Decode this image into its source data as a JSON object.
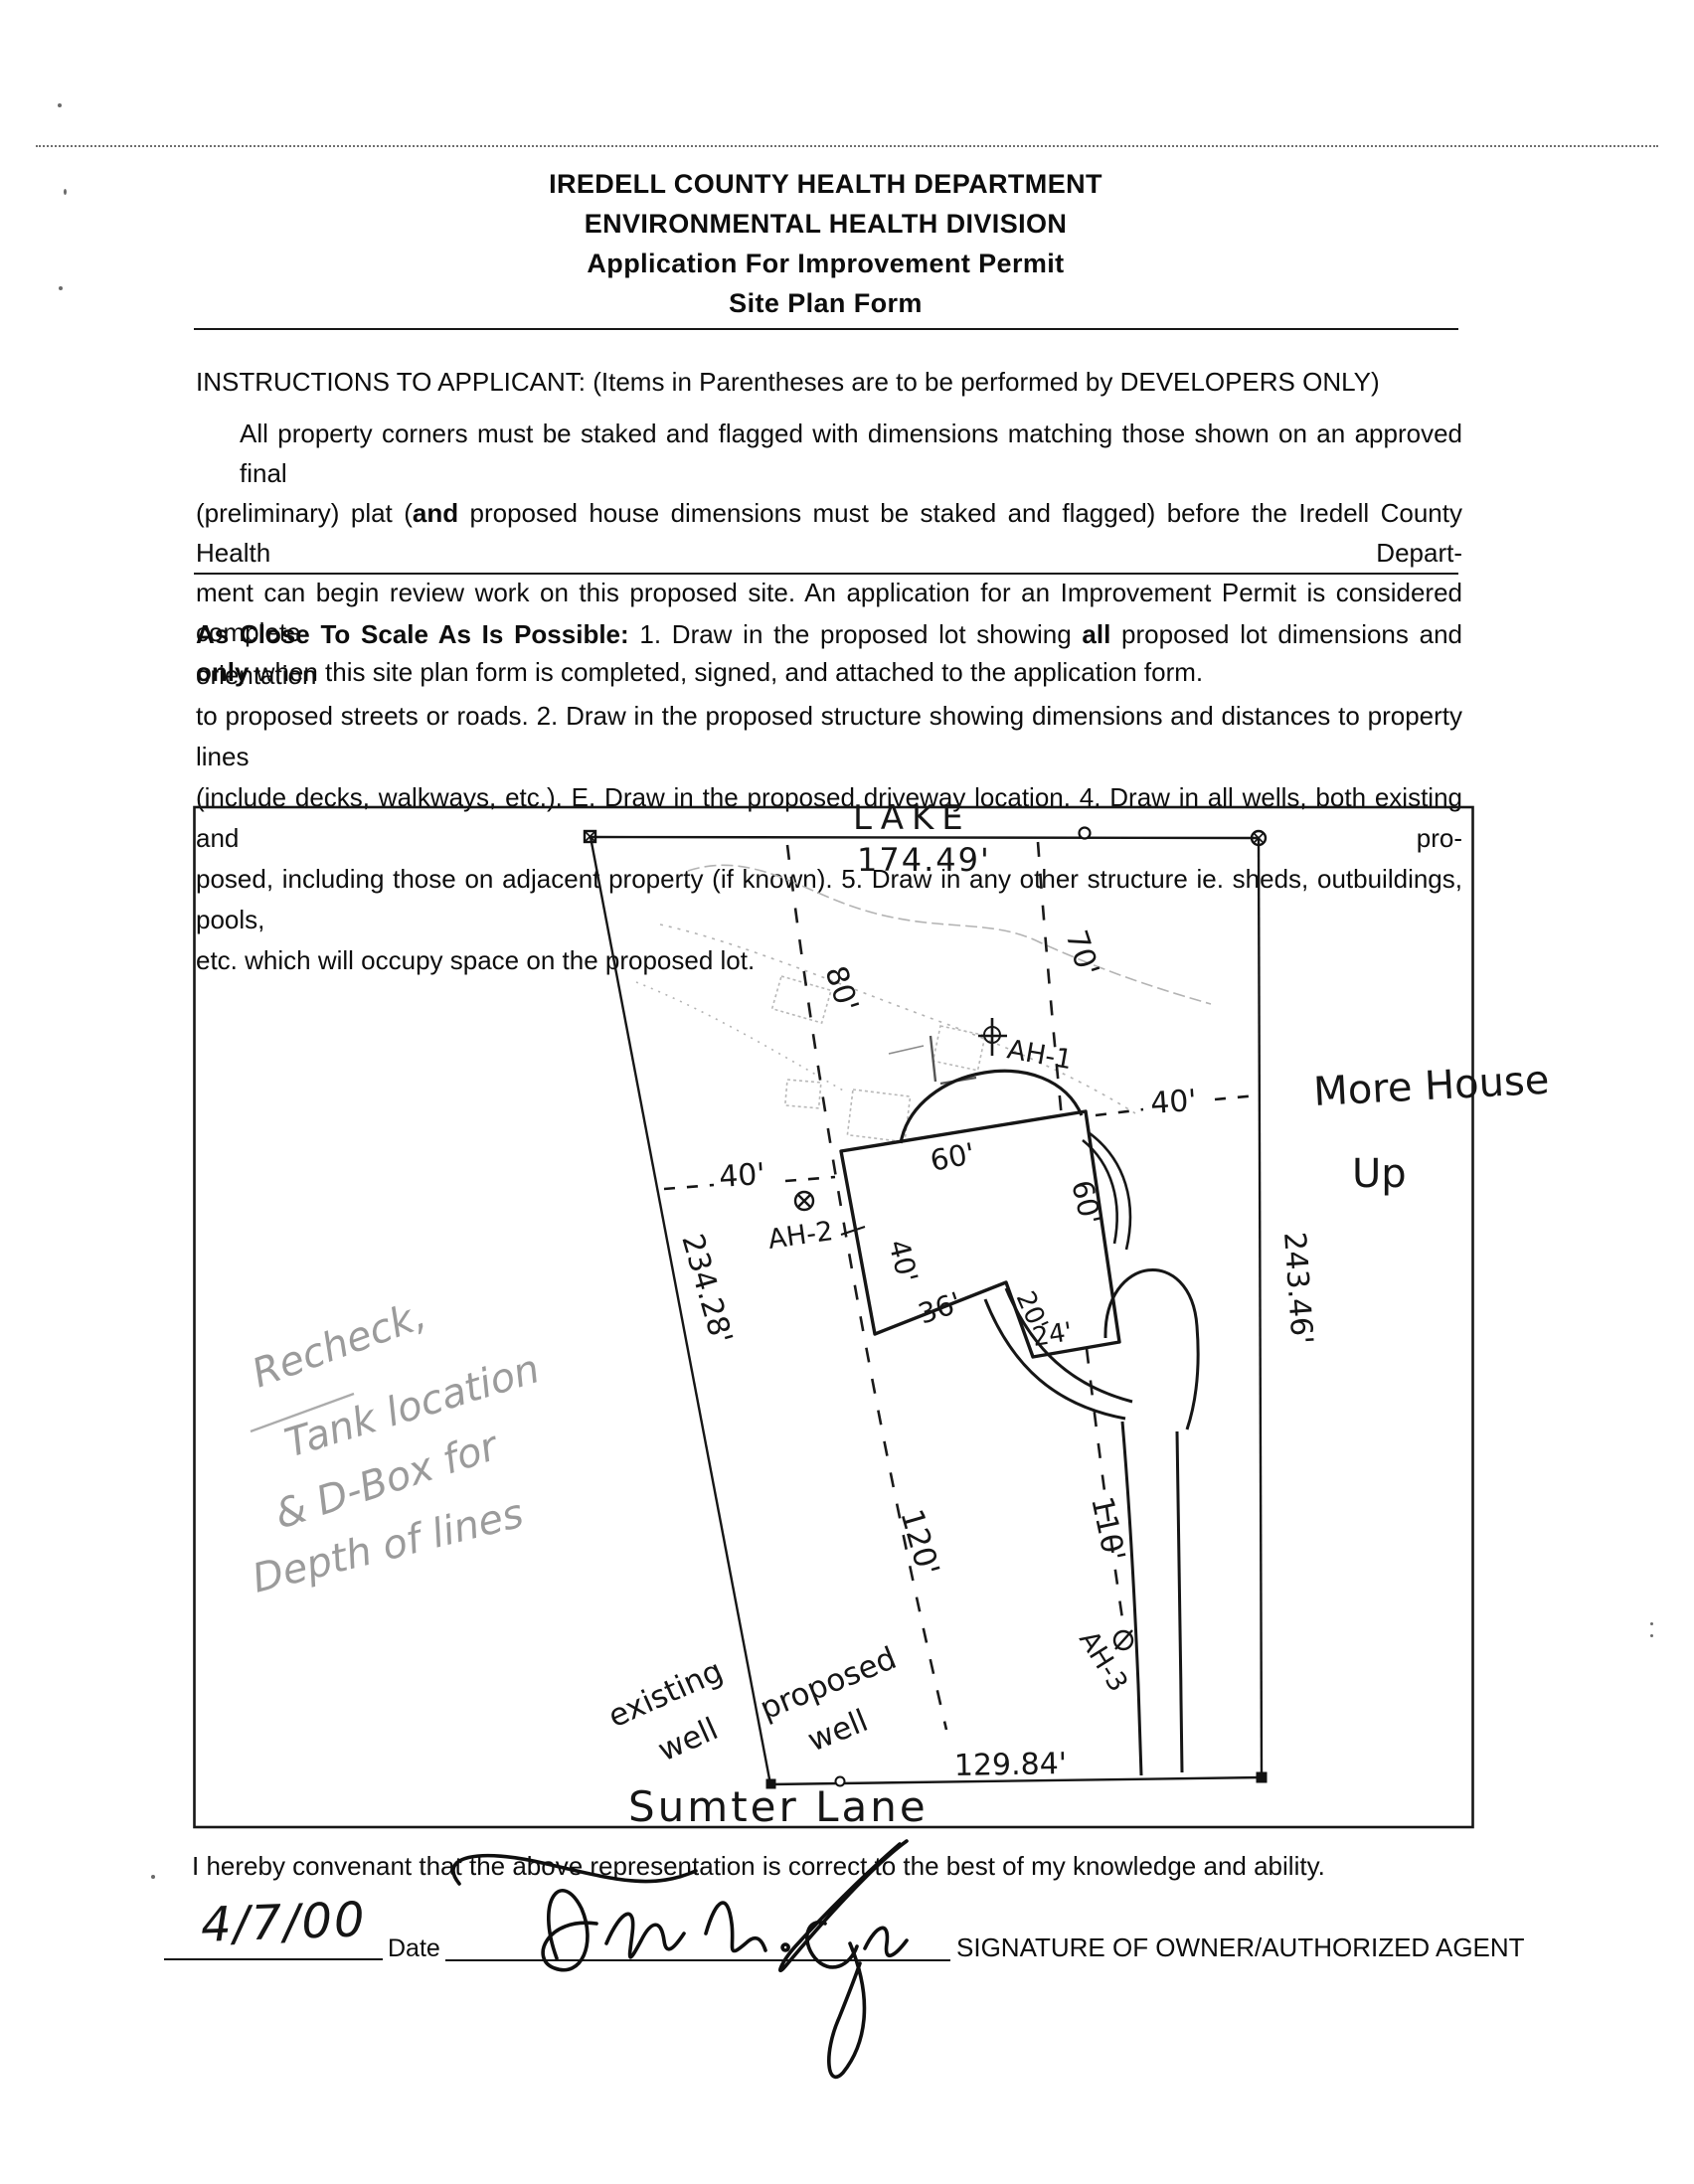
{
  "header": {
    "dept": "IREDELL COUNTY HEALTH DEPARTMENT",
    "division": "ENVIRONMENTAL HEALTH DIVISION",
    "app": "Application For Improvement Permit",
    "form": "Site Plan Form"
  },
  "instructions": {
    "heading": "INSTRUCTIONS TO APPLICANT: (Items in Parentheses are to be performed by DEVELOPERS ONLY)",
    "l1": "All property corners must be staked and flagged with dimensions matching those shown on an approved final",
    "l2a": "(preliminary) plat (",
    "l2b": "and",
    "l2c": " proposed house dimensions must be staked and flagged) before the Iredell County Health Depart-",
    "l3": "ment can begin review work on this proposed site. An application for an Improvement Permit is considered complete",
    "l4a": "only",
    "l4b": " when this site plan form is completed, signed, and attached to the application form."
  },
  "scale_note": {
    "l1a": "As Close To Scale As Is Possible:",
    "l1b": " 1. Draw in the proposed lot showing ",
    "l1c": "all",
    "l1d": " proposed lot dimensions and orientation",
    "l2": "to proposed streets or roads. 2. Draw in the proposed structure showing dimensions and distances to property lines",
    "l3": "(include decks, walkways, etc.). E. Draw in the proposed driveway location. 4. Draw in all wells, both existing and pro-",
    "l4": "posed, including those on adjacent property (if known). 5. Draw in any other structure ie. sheds, outbuildings, pools,",
    "l5": "etc. which will occupy space on the proposed lot."
  },
  "site_plan": {
    "lake": "LAKE",
    "dim_top": "174.49'",
    "dim_left": "234.28'",
    "dim_right": "243.46'",
    "dim_bottom": "129.84'",
    "setback_left_upper": "80'",
    "setback_right_upper": "70'",
    "setback_left_lower": "120'",
    "setback_right_lower": "110'",
    "well_dim_left": "40'",
    "house_dim_right": "40'",
    "house_top": "60'",
    "house_right": "60'",
    "house_left": "40'",
    "house_bottom": "36'",
    "house_step": "20'",
    "house_wing": "24'",
    "ah1": "AH-1",
    "ah2": "AH-2",
    "ah3": "AH-3",
    "existing_well_1": "existing",
    "existing_well_2": "well",
    "proposed_well_1": "proposed",
    "proposed_well_2": "well",
    "road": "Sumter Lane",
    "note_house_1": "More House",
    "note_house_2": "Up",
    "pencil_1": "Recheck,",
    "pencil_2": "Tank location",
    "pencil_3": "& D-Box for",
    "pencil_4": "Depth of lines"
  },
  "footer": {
    "covenant": "I hereby convenant that the above representation is correct to the best of my knowledge and ability.",
    "date_value": "4/7/00",
    "date_label": "Date",
    "signature_label": "SIGNATURE OF OWNER/AUTHORIZED AGENT"
  }
}
